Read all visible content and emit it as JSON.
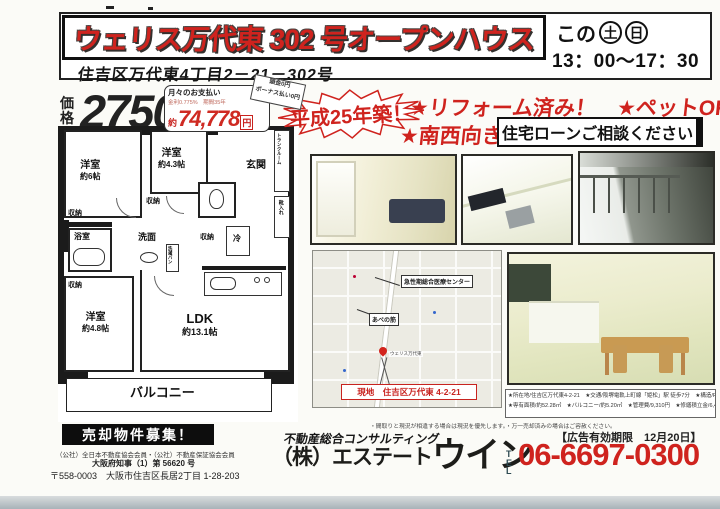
{
  "header": {
    "title": "ウェリス万代東 302 号オープンハウス",
    "address": "住吉区万代東4丁目2－21－302号",
    "day_prefix": "この",
    "day1": "土",
    "day2": "日",
    "hours": "13：00～17：30"
  },
  "price": {
    "label_top": "価",
    "label_bottom": "格",
    "amount": "2750",
    "unit_top": "万",
    "unit_bottom": "円",
    "monthly_title": "月々のお支払い",
    "monthly_terms": "金利0.775%　期間35年",
    "approx": "約",
    "monthly_amount": "74,778",
    "monthly_unit": "円",
    "badge_line1": "頭金0円",
    "badge_line2": "ボーナス払い0円"
  },
  "highlights": {
    "built": "平成25年築！",
    "reform_pets": "★リフォーム済み！　★ペットOK",
    "facing": "★南西向き",
    "loan": "住宅ローンご相談ください"
  },
  "floorplan": {
    "rooms": [
      {
        "label": "洋室",
        "size": "約6帖"
      },
      {
        "label": "洋室",
        "size": "約4.3帖"
      },
      {
        "label": "洋室",
        "size": "約4.8帖"
      },
      {
        "label": "LDK",
        "size": "約13.1帖"
      }
    ],
    "balcony": "バルコニー",
    "entrance": "玄関",
    "trunk": "トランクルーム",
    "shoe": "靴入れ",
    "storage": "収納",
    "bath": "浴室",
    "wash": "洗面",
    "laundry": "洗濯パン",
    "fridge": "冷"
  },
  "map": {
    "hospital": "急性期総合医療センター",
    "street": "あべの筋",
    "pin": "ウェリス万代東",
    "site": "現地　住吉区万代東 4-2-21"
  },
  "details": {
    "line1": "★所在地/住吉区万代東4-2-21　★交通/阪堺電軌上町線「姫松」駅 徒歩7分　★構造/RC造14階建て3階部分　★間取り/2LDK",
    "line2": "★専有面積/約52.28㎡　★バルコニー/約5.20㎡　★管理費/9,310円　★修繕積立金/6,480円　★総戸数/28戸　★駐車場/有り"
  },
  "footer": {
    "recruit": "売却物件募集！",
    "memberships": "（公社）全日本不動産協会会員・（公社）不動産保証協会会員",
    "license": "大阪府知事（1）第 56620 号",
    "address": "〒558-0003　大阪市住吉区長居2丁目 1-28-203",
    "tagline": "不動産総合コンサルティング",
    "name1": "（株）エステート",
    "name2": "ウイン",
    "tel_label": "TEL",
    "tel": "06-6697-0300",
    "disclaimer": "・間取りと現況が相違する場合は現況を優先します。・万一売却済みの場合はご容赦ください。",
    "validity": "【広告有効期限　12月20日】"
  },
  "colors": {
    "accent_red": "#cf231e",
    "ink": "#1c1c1c"
  }
}
